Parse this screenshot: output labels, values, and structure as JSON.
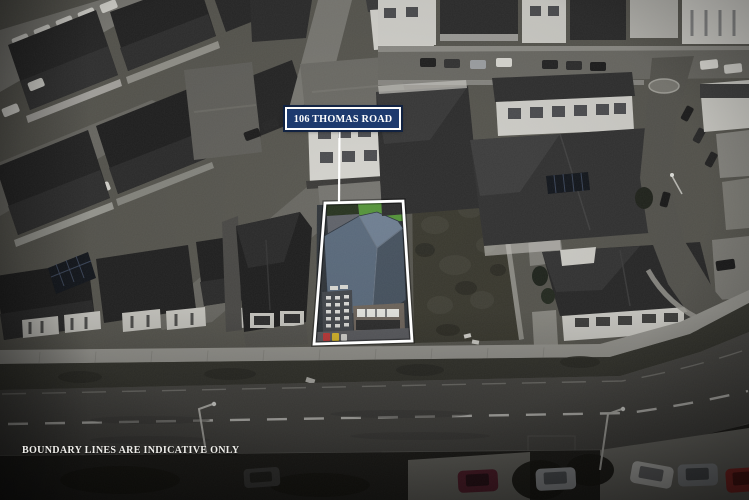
{
  "overlay": {
    "address_label": "106 THOMAS ROAD",
    "disclaimer": "BOUNDARY LINES ARE INDICATIVE ONLY"
  },
  "colors": {
    "label_background": "#1d3a6e",
    "label_border": "#ffffff",
    "label_text": "#ffffff",
    "boundary_line": "#ffffff",
    "leader_line": "#ffffff",
    "subject_roof_main": "#5a6a7c",
    "subject_roof_light": "#6f7f92",
    "subject_roof_dark": "#46525f",
    "subject_lawn": "#55943a",
    "subject_lawn_bright": "#79b23f",
    "bin_red": "#c03a3a",
    "bin_yellow": "#d8b92a",
    "car_maroon": "#5f2030",
    "car_silver": "#a7aaad",
    "car_white": "#dcdcd8",
    "car_red": "#a32c28"
  }
}
